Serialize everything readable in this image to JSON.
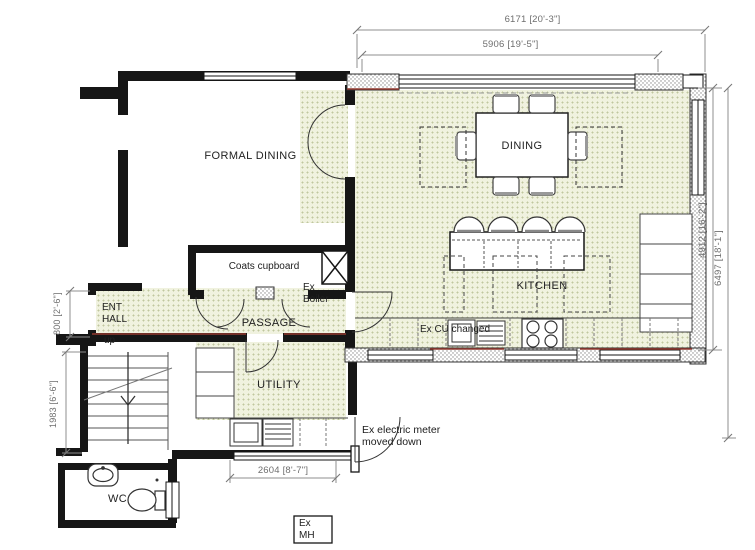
{
  "rooms": {
    "formal_dining": "FORMAL DINING",
    "dining": "DINING",
    "kitchen": "KITCHEN",
    "ent_hall_line1": "ENT",
    "ent_hall_line2": "HALL",
    "passage": "PASSAGE",
    "utility": "UTILITY",
    "wc": "WC",
    "coats_cupboard": "Coats cupboard"
  },
  "labels": {
    "stairs_up": "up",
    "boiler_line1": "Ex",
    "boiler_line2": "Boiler",
    "cu_note": "Ex CU changed",
    "meter_line1": "Ex electric meter",
    "meter_line2": "moved down",
    "mh_line1": "Ex",
    "mh_line2": "MH"
  },
  "dimensions": {
    "top_outer": "6171 [20'-3\"]",
    "top_inner": "5906 [19'-5\"]",
    "right_inner": "4912 [16'-2\"]",
    "right_outer": "6497 [18'-1\"]",
    "left_door": "800 [2'-6\"]",
    "left_stairs": "1983 [6'-6\"]",
    "bottom_utility": "2604 [8'-7\"]"
  },
  "colors": {
    "floor": "#f0f2df",
    "floor_dot": "#bfc79e",
    "wall": "#161616",
    "dimension": "#6e6e6e",
    "accent_red": "#93382f"
  }
}
